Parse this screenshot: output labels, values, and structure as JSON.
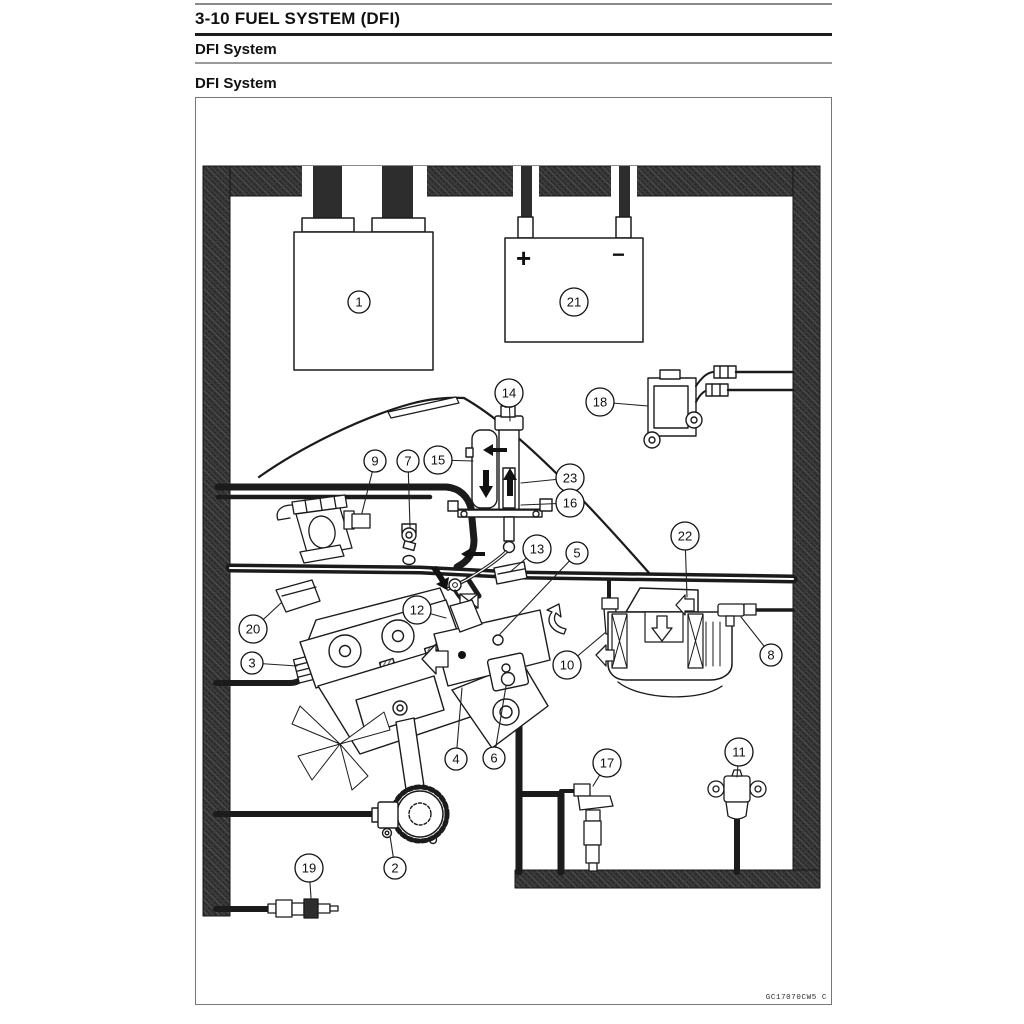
{
  "page": {
    "chapter_title": "3-10 FUEL SYSTEM (DFI)",
    "section_heading": "DFI System",
    "figure_heading": "DFI System",
    "figure_code": "GC17070CW5 C"
  },
  "diagram": {
    "battery_plus": "+",
    "battery_minus": "−",
    "callouts": [
      {
        "n": "1",
        "cx": 359,
        "cy": 302
      },
      {
        "n": "21",
        "cx": 574,
        "cy": 302
      },
      {
        "n": "18",
        "cx": 600,
        "cy": 402,
        "lx": 648,
        "ly": 406
      },
      {
        "n": "14",
        "cx": 509,
        "cy": 393,
        "lx": 510,
        "ly": 421
      },
      {
        "n": "15",
        "cx": 438,
        "cy": 460,
        "lx": 473,
        "ly": 461
      },
      {
        "n": "23",
        "cx": 570,
        "cy": 478,
        "lx": 521,
        "ly": 483
      },
      {
        "n": "16",
        "cx": 570,
        "cy": 503,
        "lx": 521,
        "ly": 505
      },
      {
        "n": "9",
        "cx": 375,
        "cy": 461,
        "lx": 362,
        "ly": 513
      },
      {
        "n": "7",
        "cx": 408,
        "cy": 461,
        "lx": 410,
        "ly": 527
      },
      {
        "n": "13",
        "cx": 537,
        "cy": 549,
        "lx": 510,
        "ly": 572
      },
      {
        "n": "5",
        "cx": 577,
        "cy": 553,
        "lx": 500,
        "ly": 634
      },
      {
        "n": "22",
        "cx": 685,
        "cy": 536,
        "lx": 687,
        "ly": 597
      },
      {
        "n": "12",
        "cx": 417,
        "cy": 610,
        "lx": 446,
        "ly": 618
      },
      {
        "n": "20",
        "cx": 253,
        "cy": 629,
        "lx": 281,
        "ly": 603
      },
      {
        "n": "3",
        "cx": 252,
        "cy": 663,
        "lx": 297,
        "ly": 666
      },
      {
        "n": "10",
        "cx": 567,
        "cy": 665,
        "lx": 606,
        "ly": 632
      },
      {
        "n": "8",
        "cx": 771,
        "cy": 655,
        "lx": 741,
        "ly": 617
      },
      {
        "n": "4",
        "cx": 456,
        "cy": 759,
        "lx": 462,
        "ly": 688
      },
      {
        "n": "6",
        "cx": 494,
        "cy": 758,
        "lx": 506,
        "ly": 686
      },
      {
        "n": "17",
        "cx": 607,
        "cy": 763,
        "lx": 593,
        "ly": 786
      },
      {
        "n": "11",
        "cx": 739,
        "cy": 752,
        "lx": 737,
        "ly": 777
      },
      {
        "n": "2",
        "cx": 395,
        "cy": 868,
        "lx": 390,
        "ly": 836
      },
      {
        "n": "19",
        "cx": 309,
        "cy": 868,
        "lx": 311,
        "ly": 898
      }
    ]
  }
}
